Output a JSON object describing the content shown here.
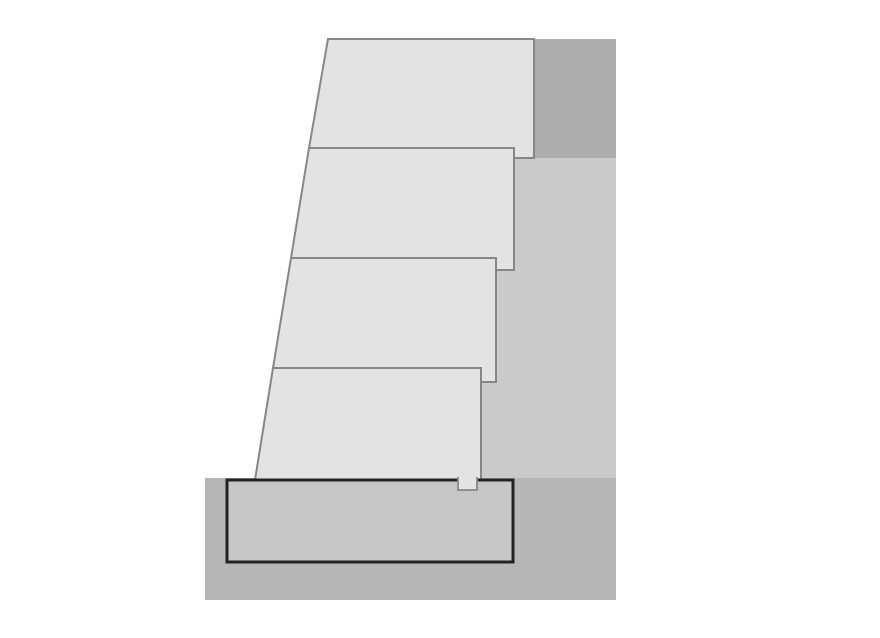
{
  "canvas": {
    "width": 880,
    "height": 638,
    "background": "#ffffff"
  },
  "figure_description": "Cross-section of a stepped modular block retaining wall on a concrete footing",
  "palette": {
    "page_background": "#ffffff",
    "block_fill": "#e3e3e3",
    "block_border": "#878787",
    "retained_soil_dark": "#adadad",
    "backfill_light": "#cacaca",
    "foundation_soil": "#b6b6b6",
    "footing_fill": "#c6c6c6",
    "footing_border": "#232323"
  },
  "diagram": {
    "shapes": [
      {
        "name": "retained-soil-upper",
        "type": "rect",
        "x": 534,
        "y": 39,
        "w": 82,
        "h": 119,
        "fill": "#adadad"
      },
      {
        "name": "backfill-zone",
        "type": "rect",
        "x": 455,
        "y": 158,
        "w": 161,
        "h": 320,
        "fill": "#cacaca"
      },
      {
        "name": "foundation-soil",
        "type": "rect",
        "x": 205,
        "y": 478,
        "w": 411,
        "h": 122,
        "fill": "#b6b6b6"
      },
      {
        "name": "wall-block-4",
        "type": "polygon",
        "points": "273,368 481,368 481,480 255,480",
        "fill": "#e3e3e3",
        "stroke": "#878787",
        "stroke_width": 2
      },
      {
        "name": "wall-block-3",
        "type": "polygon",
        "points": "291,258 496,258 496,382 481,382 481,368 273,368",
        "fill": "#e3e3e3",
        "stroke": "#878787",
        "stroke_width": 2
      },
      {
        "name": "wall-block-2",
        "type": "polygon",
        "points": "309,148 514,148 514,270 496,270 496,258 291,258",
        "fill": "#e3e3e3",
        "stroke": "#878787",
        "stroke_width": 2
      },
      {
        "name": "wall-block-1",
        "type": "polygon",
        "points": "328,39 534,39 534,158 514,158 514,148 309,148",
        "fill": "#e3e3e3",
        "stroke": "#878787",
        "stroke_width": 2
      },
      {
        "name": "concrete-footing",
        "type": "rect",
        "x": 227,
        "y": 480,
        "w": 286,
        "h": 82,
        "fill": "#c6c6c6",
        "stroke": "#232323",
        "stroke_width": 3
      },
      {
        "name": "shear-key",
        "type": "path",
        "d": "M458,477 L458,490 L477,490 L477,477",
        "fill": "#e3e3e3",
        "stroke": "#878787",
        "stroke_width": 1.8
      }
    ]
  }
}
